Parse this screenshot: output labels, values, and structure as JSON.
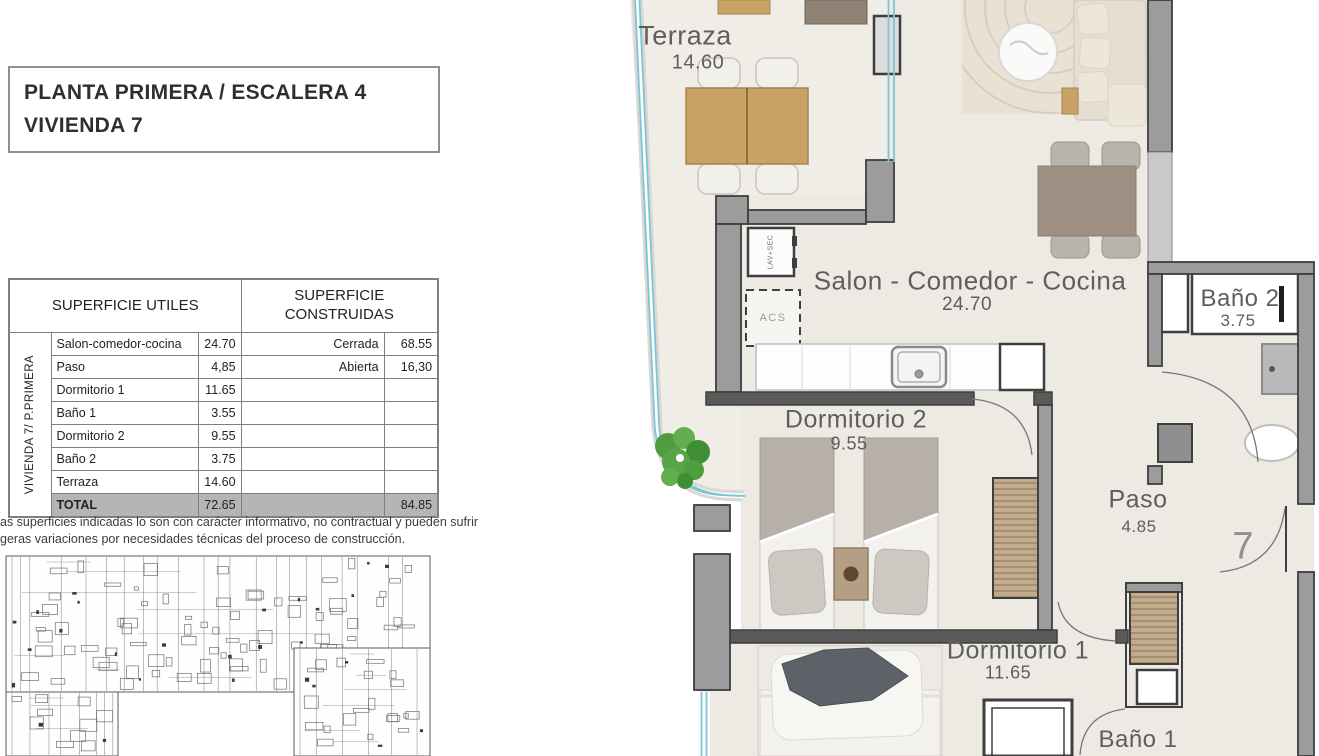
{
  "theme": {
    "floor": "#EDEAE3",
    "terrace": "#F0ECE6",
    "wall": "#9C9C9C",
    "wall_dark": "#3E3E3E",
    "glass": "#7CC5D6",
    "wood": "#C9A265",
    "taupe": "#9D9083",
    "sofa": "#E5DFD2",
    "rug": "#E9E2D4",
    "green": "#55A043",
    "curb": "#DBD7D1",
    "plan_text": "#5E5E5E",
    "total_bg": "#B5B5B5",
    "border": "#7F7F7F",
    "text": "#2F2F2F"
  },
  "title_block": {
    "line1": "PLANTA PRIMERA / ESCALERA 4",
    "line2": "VIVIENDA 7"
  },
  "areas_table": {
    "header_left": "SUPERFICIE UTILES",
    "header_right": "SUPERFICIE CONSTRUIDAS",
    "side_label": "VIVIENDA 7/ P.PRIMERA",
    "rows": [
      {
        "name": "Salon-comedor-cocina",
        "value": "24.70",
        "cname": "Cerrada",
        "cvalue": "68.55"
      },
      {
        "name": "Paso",
        "value": "4,85",
        "cname": "Abierta",
        "cvalue": "16,30"
      },
      {
        "name": "Dormitorio 1",
        "value": "11.65",
        "cname": "",
        "cvalue": ""
      },
      {
        "name": "Baño 1",
        "value": "3.55",
        "cname": "",
        "cvalue": ""
      },
      {
        "name": "Dormitorio 2",
        "value": "9.55",
        "cname": "",
        "cvalue": ""
      },
      {
        "name": "Baño 2",
        "value": "3.75",
        "cname": "",
        "cvalue": ""
      },
      {
        "name": "Terraza",
        "value": "14.60",
        "cname": "",
        "cvalue": ""
      }
    ],
    "total": {
      "name": "TOTAL",
      "value": "72.65",
      "cvalue": "84.85"
    }
  },
  "disclaimer": {
    "line1": "as superficies indicadas lo son con carácter informativo, no contractual y pueden sufrir",
    "line2": "geras variaciones por necesidades técnicas del proceso de construcción."
  },
  "floor_plan": {
    "rooms": [
      {
        "id": "terraza",
        "label": "Terraza",
        "value": "14.60"
      },
      {
        "id": "salon",
        "label": "Salon - Comedor - Cocina",
        "value": "24.70"
      },
      {
        "id": "dormitorio2",
        "label": "Dormitorio 2",
        "value": "9.55"
      },
      {
        "id": "bano2",
        "label": "Baño 2",
        "value": "3.75"
      },
      {
        "id": "paso",
        "label": "Paso",
        "value": "4.85"
      },
      {
        "id": "dormitorio1",
        "label": "Dormitorio 1",
        "value": "11.65"
      },
      {
        "id": "bano1",
        "label": "Baño 1",
        "value": ""
      }
    ],
    "annotations": {
      "unit_number": "7",
      "laundry": "LAV+SEC",
      "water_heater": "ACS"
    }
  }
}
